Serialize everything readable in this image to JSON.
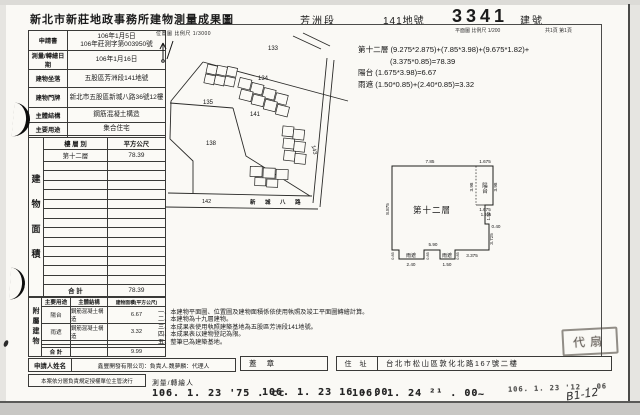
{
  "header": {
    "office_title": "新北市新莊地政事務所建物測量成果圖",
    "section": "芳洲段",
    "land_no": "141地號",
    "building_no": "3341",
    "building_no_label": "建號",
    "plan_scale": "平面圖 比例尺 1/200",
    "page_info": "共1頁 第1頁"
  },
  "info_table": {
    "rows": [
      {
        "label": "申請書",
        "value": "106年1月5日\n106年莊測字第003950號"
      },
      {
        "label": "測量/轉繪日期",
        "value": "106年1月16日"
      },
      {
        "label": "建物坐落",
        "value": "五股區芳洲段141地號"
      },
      {
        "label": "建物門牌",
        "value": "新北市五股區新城八路36號12樓"
      },
      {
        "label": "主體結構",
        "value": "鋼筋混凝土構造"
      },
      {
        "label": "主要用途",
        "value": "集合住宅"
      },
      {
        "label": "使用執照",
        "value": "105新使字第00005號"
      }
    ]
  },
  "floor_table": {
    "side_label": "建物面積",
    "col_floor": "樓 層 別",
    "col_area": "平方公尺",
    "rows": [
      {
        "floor": "第十二層",
        "area": "78.39"
      }
    ],
    "total_label": "合 計",
    "total": "78.39"
  },
  "annex_table": {
    "side_label": "附屬建物",
    "col_use": "主要用途",
    "col_structure": "主體結構",
    "col_area": "建物面積(平方公尺)",
    "rows": [
      {
        "use": "陽台",
        "structure": "鋼筋混凝土構造",
        "area": "6.67"
      },
      {
        "use": "雨遮",
        "structure": "鋼筋混凝土構造",
        "area": "3.32"
      }
    ],
    "total_label": "合 計",
    "total": "9.99"
  },
  "applicant": {
    "label": "申請人姓名",
    "value": "鑫豐開發有限公司：負責人.魏夢麟：代理人",
    "seal_label": "蓋 章"
  },
  "approval": {
    "label": "本案依分層負責規定授權單位主管決行",
    "surveyor_label": "測量/轉繪人"
  },
  "address": {
    "label": "住 址",
    "value": "台北市松山區敦化北路167號二樓"
  },
  "stamps": {
    "date_stamps": [
      "106. 1. 23 '75 . cc",
      "106. 1. 23  16 - 00",
      "106. 1. 24 ²¹ . 00",
      "~",
      "106. 1. 23 '12 . 06"
    ],
    "handwritten": "B1-12",
    "seal_text": "代扇"
  },
  "location_map": {
    "scale_label": "位置圖 比例尺 1/3000",
    "parcels": {
      "p133": "133",
      "p134": "134",
      "p135": "135",
      "p138": "138",
      "p141": "141",
      "p142": "142",
      "p143": "143"
    },
    "road": "新 城 八 路"
  },
  "calc": {
    "lines": [
      "第十二層 (9.275*2.875)+(7.85*3.98)+(9.675*1.82)+",
      "(3.375*0.85)=78.39",
      "陽台 (1.675*3.98)=6.67",
      "雨遮 (1.50*0.85)+(2.40*0.85)=3.32"
    ]
  },
  "floor_plan": {
    "room_label": "第十二層",
    "balcony_label": "陽台",
    "canopy_label_1": "雨遮",
    "canopy_label_2": "雨遮",
    "dims": {
      "top": "7.85",
      "balcony_top": "1.675",
      "balcony_left": "3.98",
      "balcony_right": "3.98",
      "balcony_bottom": "1.675",
      "offset": "1.925",
      "right1": "1.82",
      "step": "0.40",
      "right2": "3.725",
      "bottom_right": "3.375",
      "left": "8.875",
      "span": "5.90",
      "canopy1_w": "2.40",
      "canopy2_w": "1.50",
      "depth_a": "0.85",
      "depth_b": "0.85",
      "depth_c": "0.85"
    }
  },
  "notes": {
    "lines": [
      "一、本建物平面圖、位置圖及建物面積係依使用執照及竣工平面圖轉繪計算。",
      "二、本建物為十九層建物。",
      "三、本成果表使用執照建築基地為五股區芳洲段141地號。",
      "四、本成果表以建物登記為限。",
      "五、整筆已為建築基地。"
    ]
  }
}
